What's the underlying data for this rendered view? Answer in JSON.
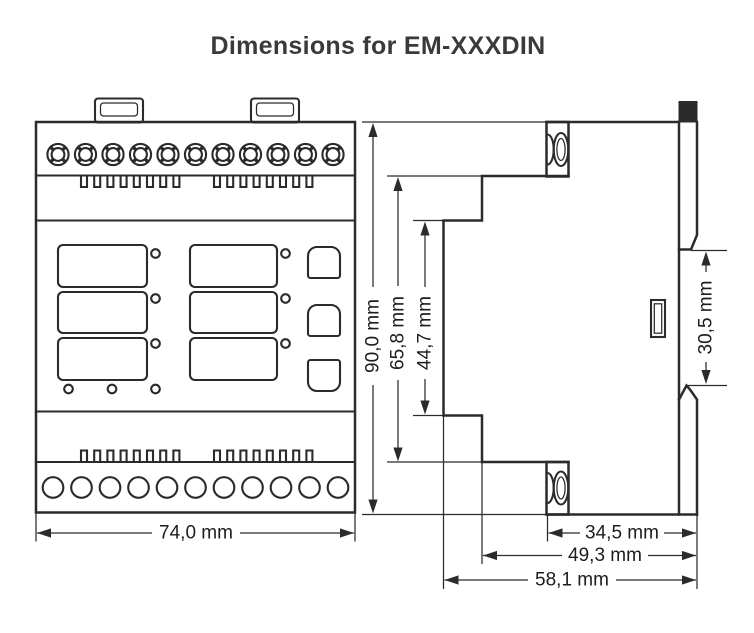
{
  "title": "Dimensions for EM-XXXDIN",
  "product": "EM-XXXDIN",
  "unit": "mm",
  "front_view": {
    "dimensions": {
      "width": {
        "label": "74,0 mm",
        "mm": 74.0
      }
    }
  },
  "side_view": {
    "dimensions": {
      "total_height": {
        "label": "90,0 mm",
        "mm": 90.0
      },
      "body_height": {
        "label": "65,8 mm",
        "mm": 65.8
      },
      "front_panel_height": {
        "label": "44,7 mm",
        "mm": 44.7
      },
      "din_rail_section_height": {
        "label": "30,5 mm",
        "mm": 30.5
      },
      "rear_section_depth": {
        "label": "34,5 mm",
        "mm": 34.5
      },
      "body_depth": {
        "label": "49,3 mm",
        "mm": 49.3
      },
      "total_depth": {
        "label": "58,1 mm",
        "mm": 58.1
      }
    }
  },
  "colors": {
    "line": "#2b2b2b",
    "title": "#3a3a3a",
    "background": "#ffffff"
  }
}
